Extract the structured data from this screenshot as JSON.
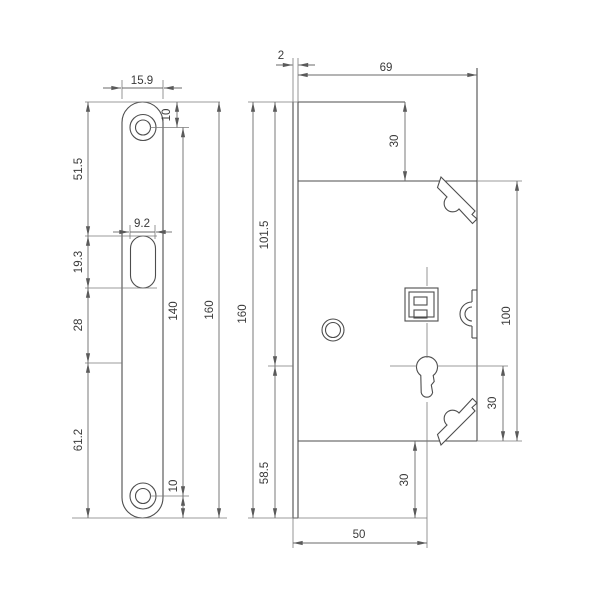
{
  "drawing": {
    "type": "technical-drawing",
    "subject": "mortise lock case - faceplate front view and lock body side view",
    "units": "mm",
    "colors": {
      "background": "#ffffff",
      "line": "#4d4d4d",
      "dimension_line": "#6a6a6a",
      "text": "#3a3a3a"
    }
  },
  "front_view": {
    "name": "faceplate-front-view",
    "dims": {
      "plate_width": "15.9",
      "top_hole_offset": "10",
      "top_to_slot": "51.5",
      "slot_width": "9.2",
      "slot_height": "19.3",
      "slot_to_key": "28",
      "key_to_bottom": "61.2",
      "hole_spacing": "140",
      "total_height": "160",
      "bottom_hole_offset": "10"
    }
  },
  "side_view": {
    "name": "lock-case-side-view",
    "dims": {
      "faceplate_thickness": "2",
      "case_depth": "69",
      "top_to_latch": "30",
      "top_to_key": "101.5",
      "total_height": "160",
      "latch_to_case_bottom": "100",
      "key_to_case_bottom": "30",
      "key_to_plate_bottom": "58.5",
      "case_to_plate_bottom": "30",
      "backset": "50"
    }
  }
}
